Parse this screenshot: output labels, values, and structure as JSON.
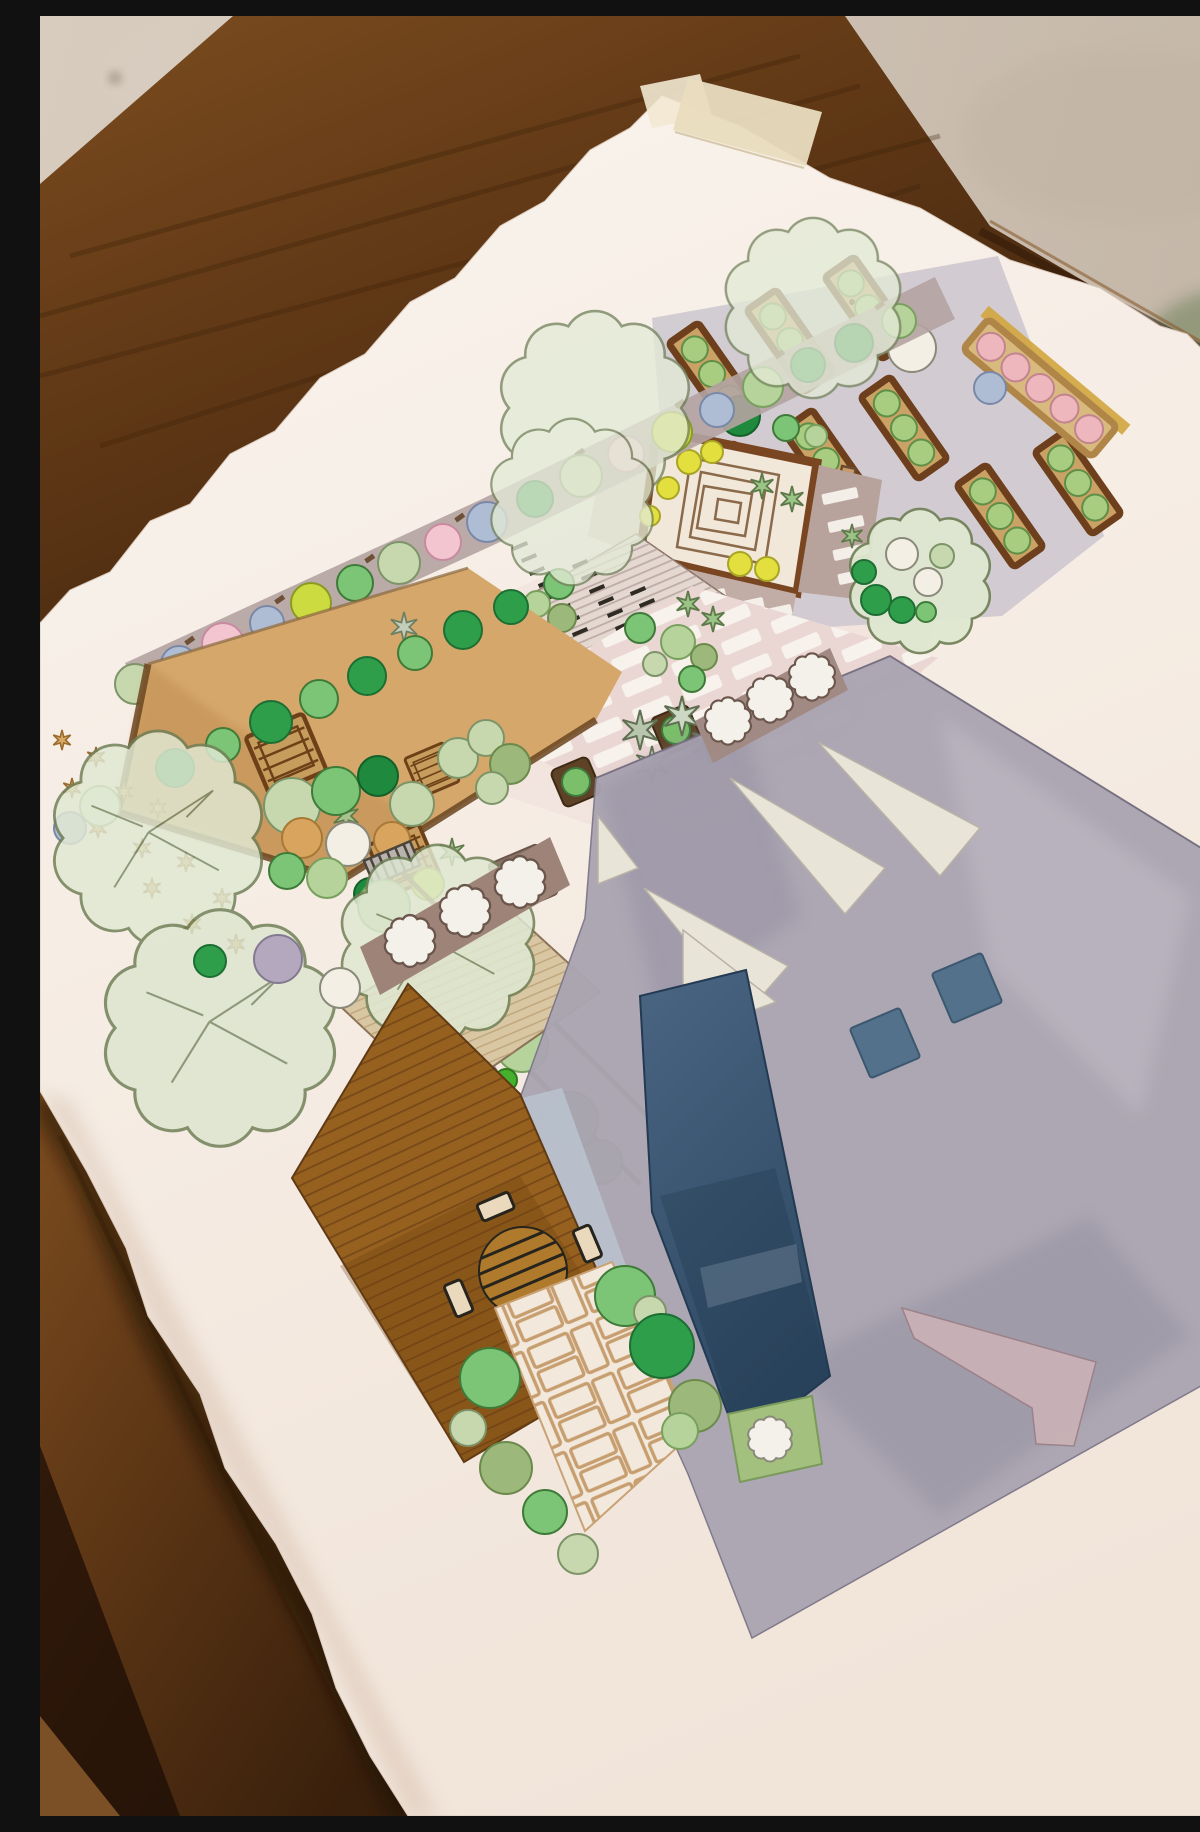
{
  "alt": "Photograph of a hand-painted watercolor landscape garden plan on a white deckle-edged sheet, taped to a dark wooden table standing on a concrete floor",
  "scene": {
    "floor": {
      "label": "Concrete floor",
      "color": "#cbbfb1",
      "green_mat_color": "#8f9678"
    },
    "table": {
      "label": "Dark walnut table",
      "wood_color": "#5a3414",
      "shadow_color": "#1c0e05"
    },
    "paper": {
      "label": "Watercolor paper sheet with deckled edges",
      "color": "#f7f0e9"
    },
    "tape": {
      "label": "Masking tape holding the sheet",
      "color": "#e9dcbf"
    },
    "plan": {
      "label": "Watercolor garden landscape plan",
      "areas": {
        "veggie_beds": {
          "label": "Raised vegetable beds with round green crops",
          "frame": "#6e3f1c",
          "soil": "#caa265",
          "crop": "#a9cd80",
          "count": 8
        },
        "pink_bed": {
          "label": "Long flower bed with pink blooms and gold edge",
          "frame": "#b08648",
          "bloom": "#eeb6bd",
          "edge": "#d2a53d"
        },
        "spiral_patio": {
          "label": "Square courtyard with concentric paving motif",
          "frame": "#7a4621",
          "fill": "#f2e8da",
          "lights": "#e3df3f"
        },
        "border_row": {
          "label": "Mixed shrub border in mauve bed",
          "bed": "#b4a3a1",
          "shrub_colors": [
            "#c7d8ae",
            "#aebdd3",
            "#f2c5d0",
            "#ccdb3f",
            "#7cc576",
            "#2f9e4b",
            "#1f8a3d"
          ]
        },
        "pergola_deck": {
          "label": "Striped pergola decking with joist marks",
          "fill": "#e5d8d0",
          "stripe": "#b3a19c"
        },
        "paver_patio": {
          "label": "Pink paver terrace with white pavers",
          "fill": "#ead7d3",
          "paver": "#f7f3ec"
        },
        "lawn": {
          "label": "Ochre lawn with timber crates and star plants",
          "fill": "#d5a76b",
          "crate": "#c79d5d",
          "flowers": "#d9a968"
        },
        "clusters": {
          "label": "Mixed shrub clusters with orange and white shrubs",
          "colors": [
            "#c9d8b0",
            "#8cbf7a",
            "#3e8e4a",
            "#d9a55e",
            "#f3efe4",
            "#c6d64f"
          ]
        },
        "canopies": {
          "label": "Large pale-green tree canopies",
          "fill": "#e3ead6",
          "line": "#74845e"
        },
        "walkway": {
          "label": "Planted walkway strip with round shrubs",
          "edge": "#6a4520",
          "shrubs": [
            "#bcd8a4",
            "#9cb87a",
            "#b3a8bd",
            "#46b02e"
          ]
        },
        "light_deck": {
          "label": "Light timber deck",
          "fill": "#d9c7a4"
        },
        "dining_deck": {
          "label": "Brown dining deck with round table and four chairs",
          "fill": "#96601f",
          "ink": "#26241c"
        },
        "stepping_path": {
          "label": "Stepping-stone paths with white flagstones",
          "band": "#9e8478",
          "stone": "#f4f1ea"
        },
        "driveway": {
          "label": "Large grey paved plaza",
          "fill": "#aaa5b1"
        },
        "wedges": {
          "label": "Cream paving wedges and pink wedge",
          "fill": "#e9e4d8",
          "pink": "#cbb2b6"
        },
        "pools": {
          "label": "Navy lap-pool bands",
          "fill": "#3c5674",
          "sliver": "#bcc6d2"
        },
        "slate_squares": {
          "label": "Two slate-blue square pads",
          "fill": "#54718c"
        },
        "brick_path": {
          "label": "Basket-weave brick path with hedge",
          "line": "#c79e6f",
          "hedge": "#7fbf72"
        },
        "green_patch": {
          "label": "Green patch with white flagstone",
          "fill": "#a3c07f"
        },
        "big_tree": {
          "label": "Round specimen tree with white and green shrubs",
          "fill": "#dfe8d0"
        }
      }
    }
  }
}
